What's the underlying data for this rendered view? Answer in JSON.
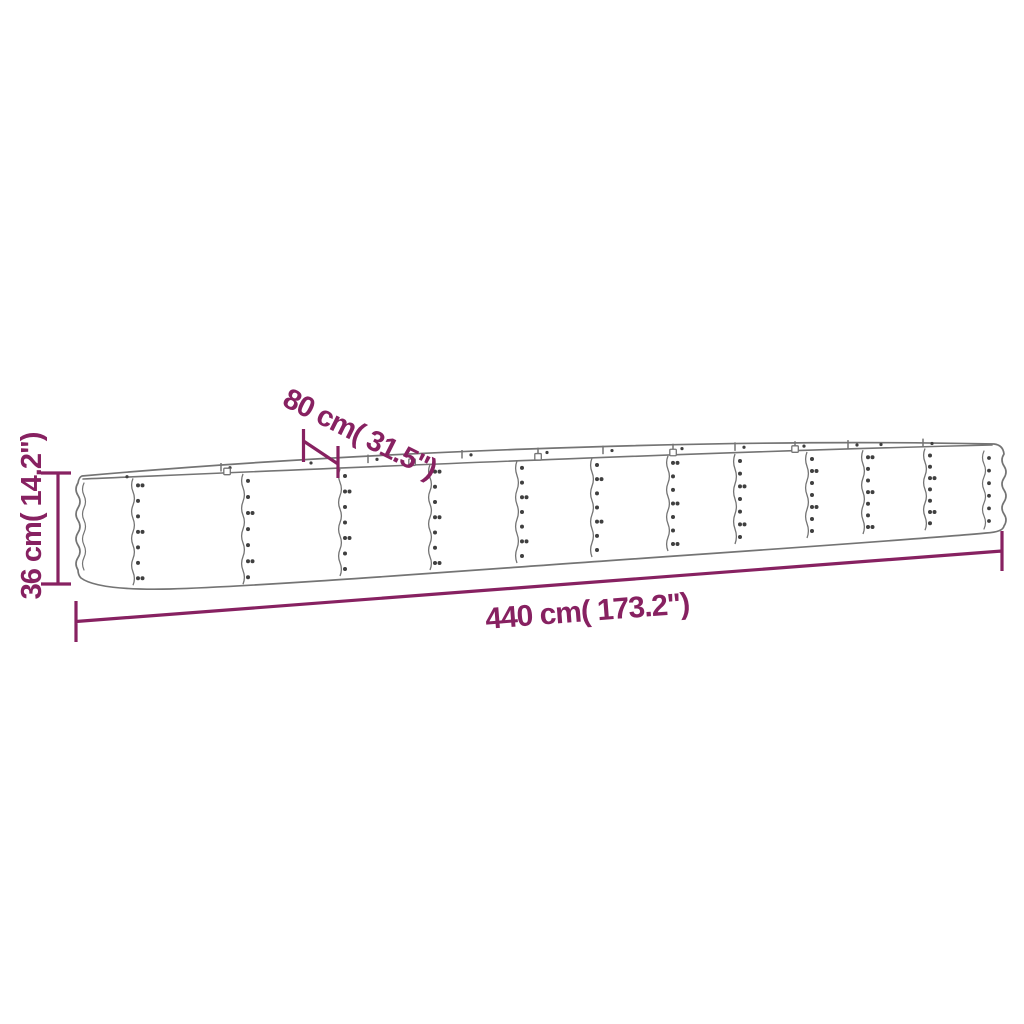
{
  "page": {
    "background": "#ffffff"
  },
  "diagram": {
    "type": "product-dimension-diagram",
    "subject": "oval corrugated-steel raised garden bed (outline drawing)",
    "outline_color": "#747474",
    "rivet_color": "#3f3f3f",
    "dimension_color": "#872161",
    "dimensions": {
      "height": "36 cm( 14.2\")",
      "width": "80 cm( 31.5\")",
      "length": "440 cm( 173.2\")"
    }
  }
}
